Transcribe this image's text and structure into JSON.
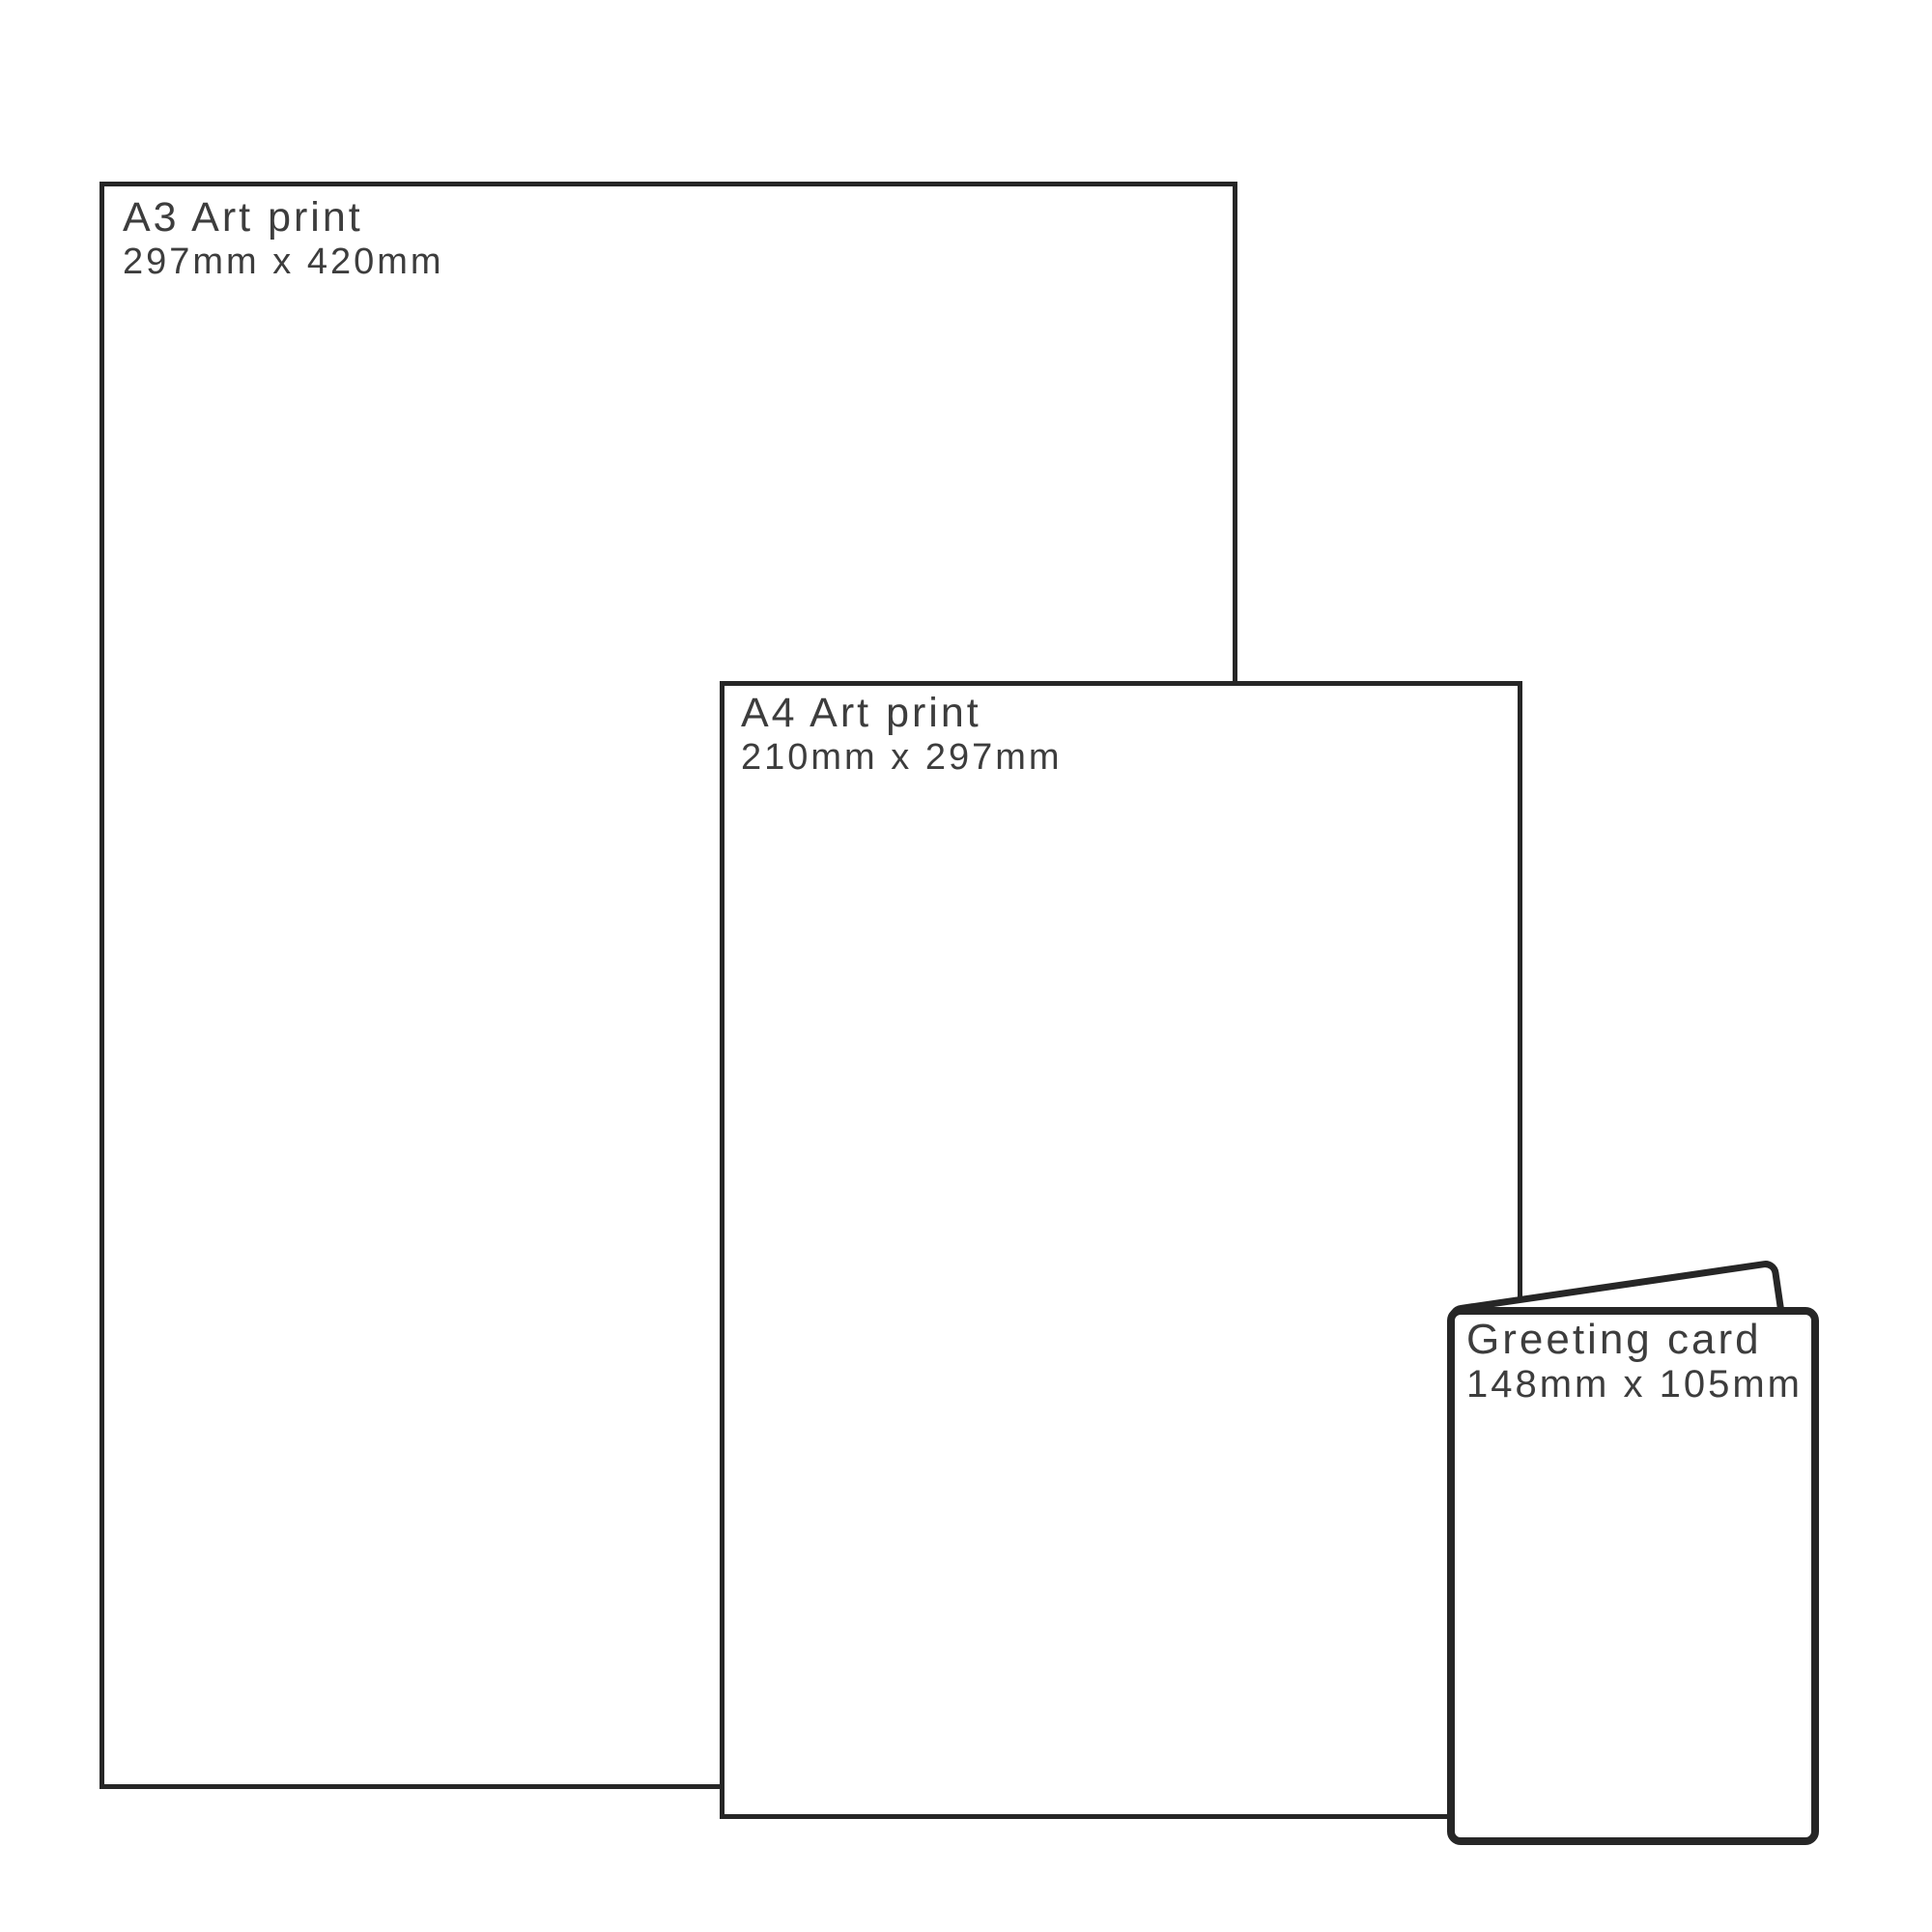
{
  "canvas": {
    "background_color": "#ffffff",
    "stroke_color": "#262626",
    "text_color": "#3d3d3d"
  },
  "items": [
    {
      "id": "a3-art-print",
      "title": "A3 Art print",
      "dimensions": "297mm x 420mm"
    },
    {
      "id": "a4-art-print",
      "title": "A4 Art print",
      "dimensions": "210mm x 297mm"
    },
    {
      "id": "greeting-card",
      "title": "Greeting card",
      "dimensions": "148mm x 105mm"
    }
  ]
}
